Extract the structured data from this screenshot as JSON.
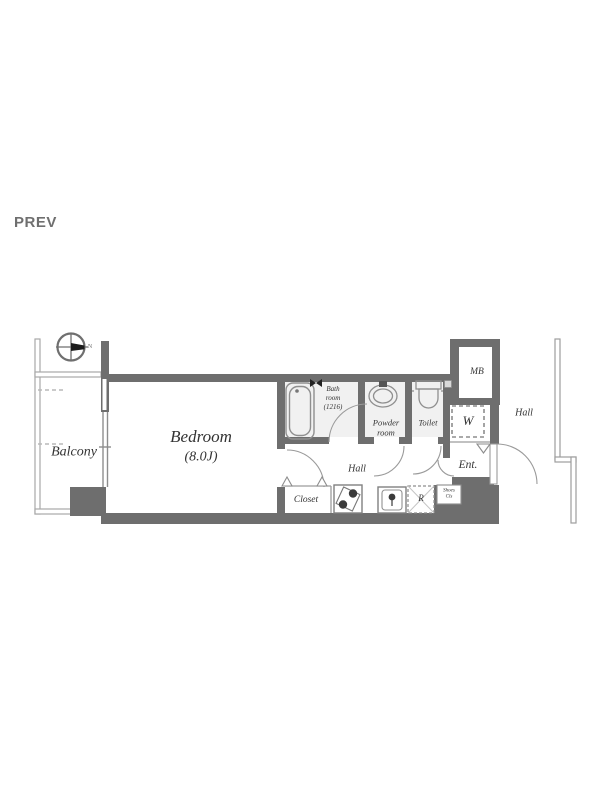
{
  "nav": {
    "prev": "PREV"
  },
  "rooms": {
    "balcony": "Balcony",
    "bedroom": {
      "name": "Bedroom",
      "size": "(8.0J)"
    },
    "bath": {
      "line1": "Bath",
      "line2": "room",
      "line3": "(1216)"
    },
    "powder": {
      "line1": "Powder",
      "line2": "room"
    },
    "toilet": "Toilet",
    "mb": "MB",
    "washer": "W",
    "hall_outside": "Hall",
    "hall_inside": "Hall",
    "entrance": "Ent.",
    "closet": "Closet",
    "shoes": {
      "line1": "Shoes",
      "line2": "Cls"
    },
    "refrigerator": "R"
  },
  "compass": {
    "north": "N"
  },
  "colors": {
    "wall": "#6e6e6e",
    "thin_line": "#a8a8a8",
    "fixture": "#8f8f8f",
    "arc": "#9a9a9a",
    "label_text": "#333333",
    "prev_text": "#6f6f6f",
    "room_tint": "#f1f1f1"
  }
}
